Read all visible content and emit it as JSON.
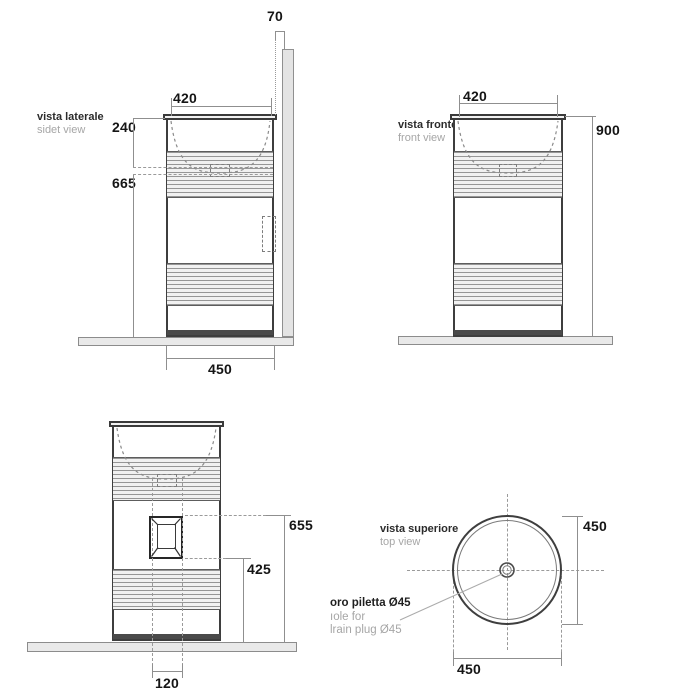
{
  "views": {
    "side": {
      "label_it": "vista laterale",
      "label_en": "sidet view",
      "dim_wall_offset": "70",
      "dim_top_width": "420",
      "dim_basin_depth": "240",
      "dim_under_basin": "665",
      "dim_base_width": "450"
    },
    "front": {
      "label_it": "vista fronte",
      "label_en": "front view",
      "dim_top_width": "420",
      "dim_height": "900"
    },
    "back": {
      "dim_niche_top": "655",
      "dim_niche_bottom": "425",
      "dim_niche_width": "120"
    },
    "top": {
      "label_it": "vista superiore",
      "label_en": "top view",
      "dim_diameter_right": "450",
      "dim_diameter_bottom": "450",
      "note_line1": "oro piletta Ø45",
      "note_line2": "ıole for",
      "note_line3": "lrain plug Ø45"
    }
  },
  "colors": {
    "outline": "#3e3e3e",
    "dim_line": "#8f8f8f",
    "fill_light": "#e9e9e9",
    "text_dark": "#151515",
    "text_gray": "#a6a6a6"
  }
}
